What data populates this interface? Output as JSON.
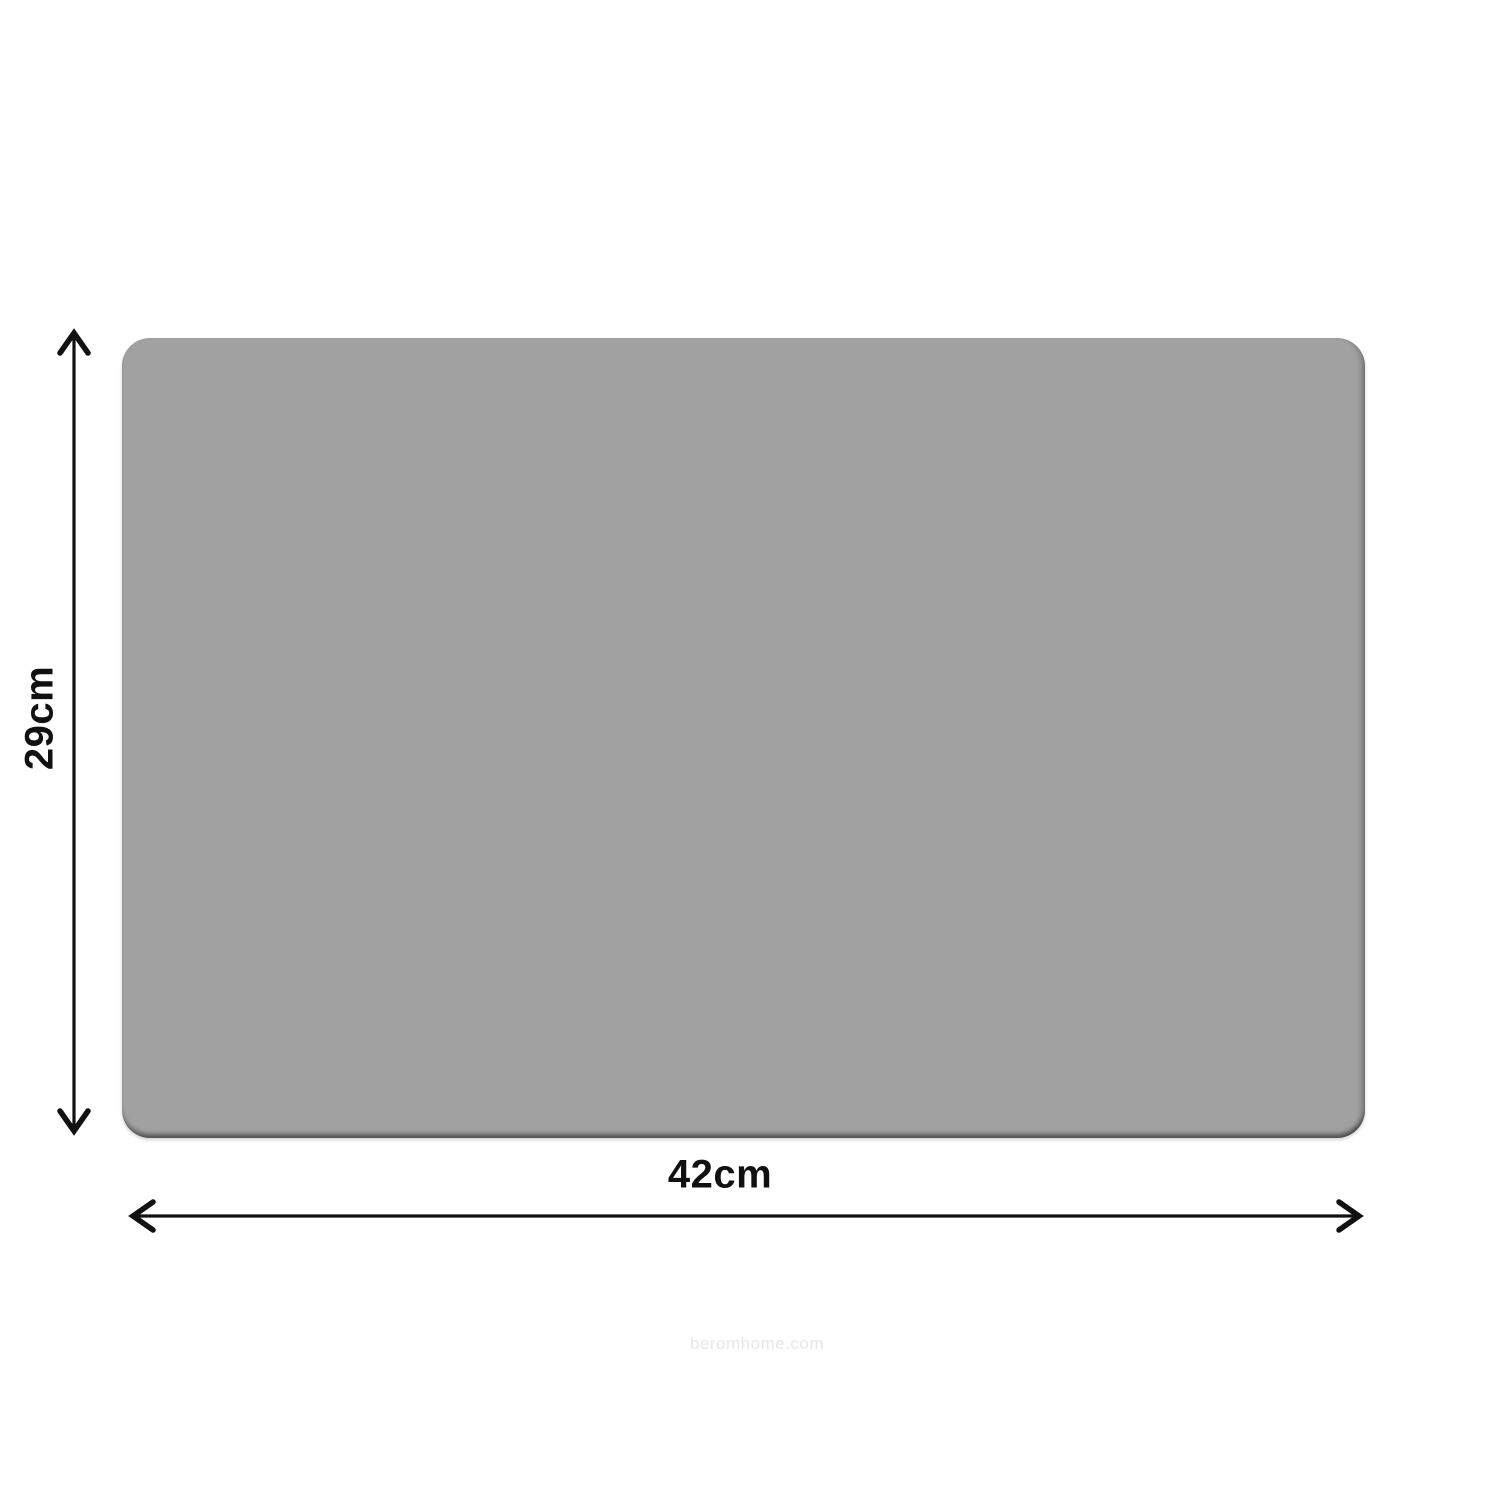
{
  "product": {
    "shape": "rounded-rectangle placemat",
    "fill_color": "#a1a1a1",
    "edge_shadow_color": "#5f5f5f",
    "corner_radius_px": 28
  },
  "dimensions": {
    "height_label": "29cm",
    "width_label": "42cm"
  },
  "watermark": "beromhome.com",
  "colors": {
    "background": "#ffffff",
    "arrow": "#111111",
    "label_text": "#111111",
    "watermark_text": "#e7e7e7"
  }
}
